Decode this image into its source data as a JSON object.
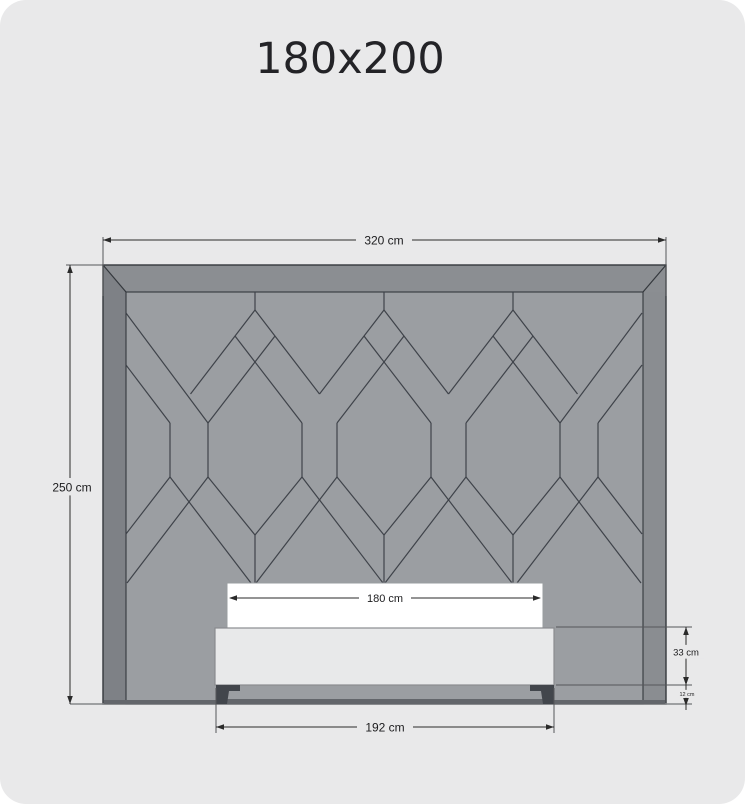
{
  "title": "180x200",
  "colors": {
    "page_bg": "#e9e9ea",
    "panel_field": "#9b9ea2",
    "panel_border_top": "#8b8e92",
    "panel_border_left": "#7e8186",
    "panel_border_right": "#8a8d91",
    "panel_outline": "#34383d",
    "pattern_line": "#3f434a",
    "panel_bottom_shadow": "#63666b",
    "mattress_fill": "#ffffff",
    "mattress_stroke": "#9a9da0",
    "bedframe_fill": "#e8e9ea",
    "bedframe_stroke": "#8a8c8f",
    "leg_fill": "#42464c",
    "dim_line": "#2a2a2a",
    "ext_line": "#55575a",
    "floor_line": "#85878a",
    "label_color": "#1c1c1e"
  },
  "dimensions": {
    "width_total": {
      "label": "320 cm"
    },
    "height_total": {
      "label": "250 cm"
    },
    "mattress_width": {
      "label": "180 cm"
    },
    "base_width": {
      "label": "192 cm"
    },
    "frame_height": {
      "label": "33 cm"
    },
    "legs_height": {
      "label": "12 cm"
    }
  }
}
